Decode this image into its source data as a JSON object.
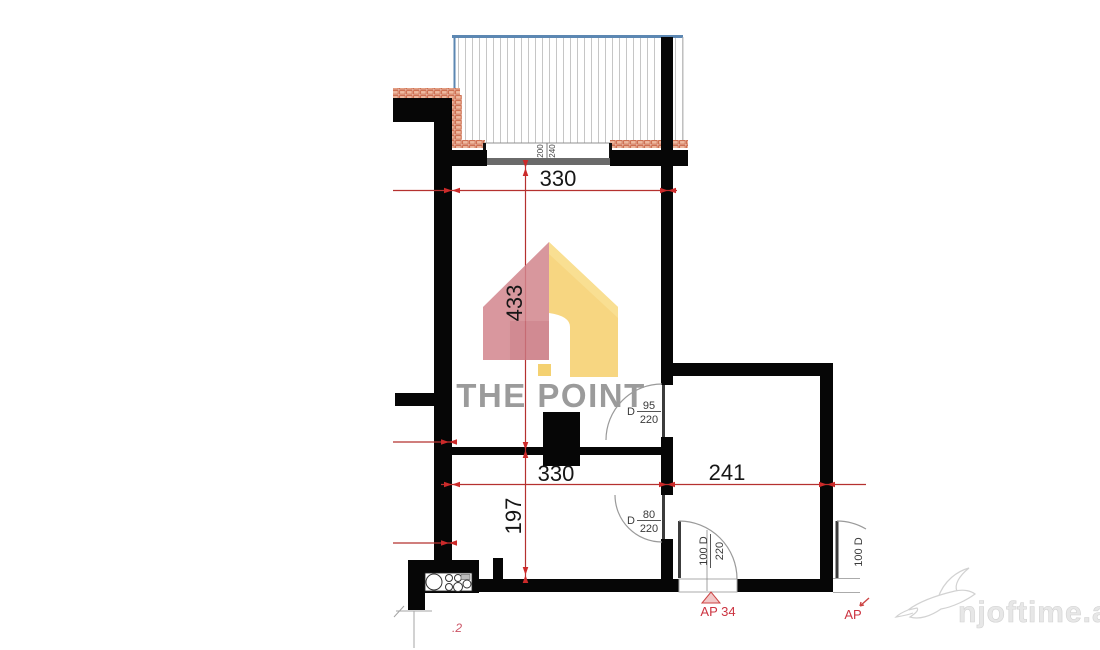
{
  "plan": {
    "dimensions": {
      "top_width": "330",
      "height_upper": "433",
      "inner_width": "330",
      "right_width": "241",
      "height_lower": "197"
    },
    "window": {
      "pane_left": "200",
      "pane_right": "240"
    },
    "doors": {
      "d95": {
        "letter": "D",
        "width": "95",
        "height": "220"
      },
      "d80": {
        "letter": "D",
        "width": "80",
        "height": "220"
      },
      "entry": {
        "size": "100 D",
        "height": "220",
        "label": "AP 34"
      },
      "neighbor": {
        "size": "100 D",
        "label": "AP"
      }
    },
    "note": ".2"
  },
  "watermarks": {
    "brand": "THE POINT",
    "site": "njoftime.al"
  },
  "colors": {
    "wall_black": "#060606",
    "dimension_red": "#b5312f",
    "terrace_blue": "#5c87b2",
    "brick_orange": "#c75b39",
    "logo_pink": "#d2858d",
    "logo_yellow": "#f6d06c",
    "brand_gray": "#9b9b9b",
    "watermark_gray": "#e7e7e7"
  }
}
